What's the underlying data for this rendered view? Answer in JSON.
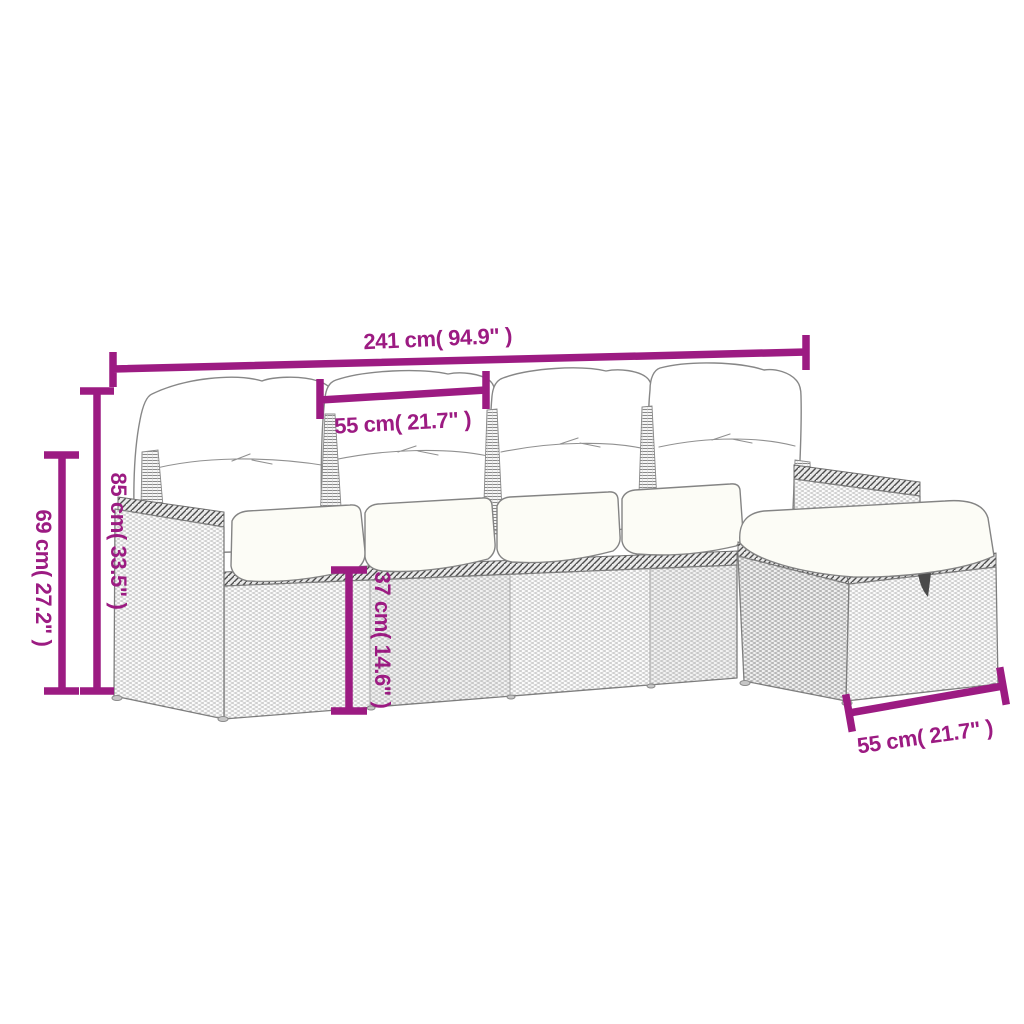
{
  "diagram": {
    "type": "product-dimension-diagram",
    "subject": "poly-rattan garden lounge set with cushions and footstool",
    "background_color": "#ffffff",
    "accent_color": "#9C1B82",
    "art_line_color": "#7e7e7e",
    "labels": {
      "total_width": "241 cm( 94.9\" )",
      "seat_width": "55 cm( 21.7\" )",
      "back_height": "85 cm( 33.5\" )",
      "arm_height": "69 cm( 27.2\" )",
      "base_height": "37 cm( 14.6\" )",
      "stool_width": "55 cm( 21.7\" )"
    }
  }
}
